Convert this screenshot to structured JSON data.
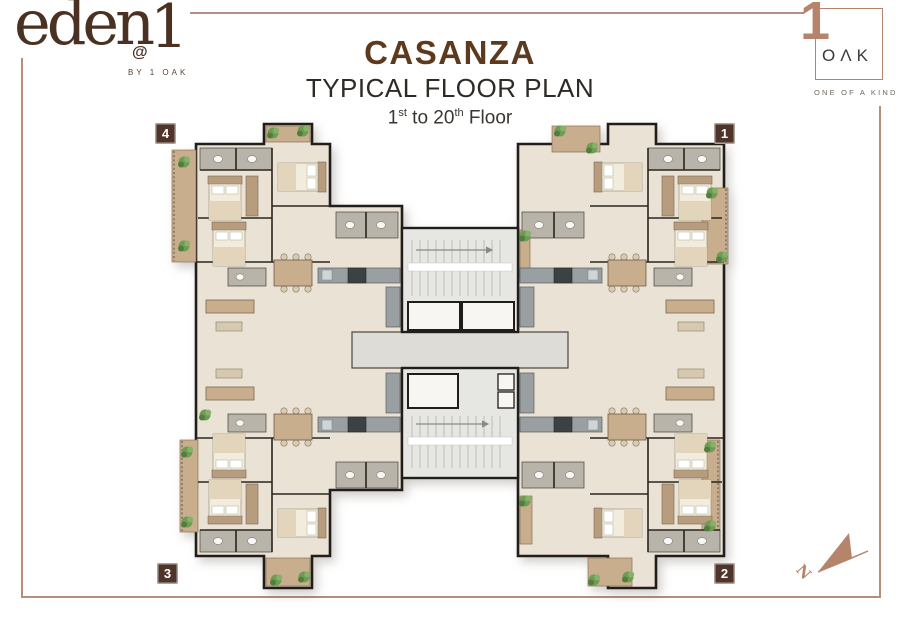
{
  "brand_left": {
    "word": "eden",
    "at": "@",
    "one": "1",
    "byline": "BY 1 OAK"
  },
  "header": {
    "title": "CASANZA",
    "subtitle": "TYPICAL FLOOR PLAN",
    "floor": {
      "n1": "1",
      "s1": "st",
      "mid": " to 20",
      "s2": "th",
      "tail": " Floor"
    }
  },
  "brand_right": {
    "one": "1",
    "letters": "OΛK",
    "tagline": "ONE OF A KIND"
  },
  "badges": {
    "unit1": "1",
    "unit2": "2",
    "unit3": "3",
    "unit4": "4"
  },
  "compass": {
    "label": "N"
  },
  "colors": {
    "frame": "#b68e7b",
    "title_brown": "#5d3a1d",
    "logo_brown": "#4a3122",
    "copper": "#b5846a",
    "badge": "#4f342a",
    "wall": "#201d1a",
    "floor": "#eae2d4",
    "bath": "#b8b4aa",
    "wood": "#c9ae8e",
    "wood2": "#b79d7e",
    "plant": "#6f9c55",
    "plant_dark": "#527d3c",
    "plant_light": "#85b268",
    "stair": "#e6e6e2",
    "corridor": "#dddcd6",
    "counter": "#9aa0a2",
    "appliance": "#3c4144",
    "text_dark": "#2e2a26",
    "text_gray": "#6e6860"
  }
}
